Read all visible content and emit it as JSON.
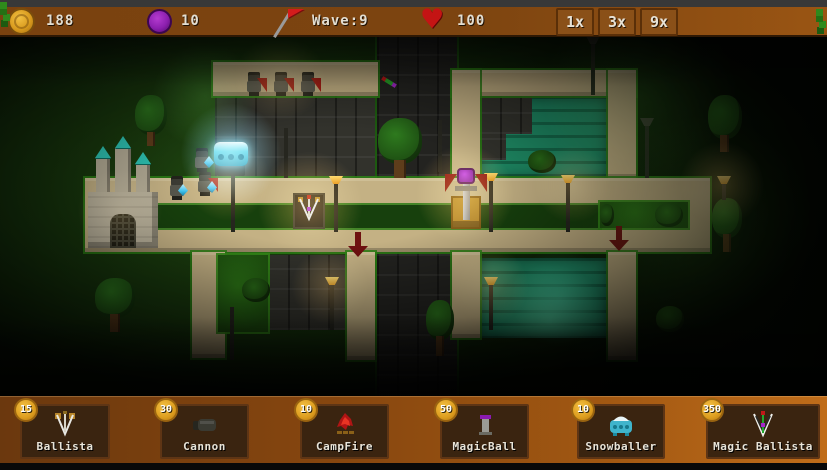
{
  "chrome": {
    "topbar_color": "#383838"
  },
  "hud": {
    "coins": "188",
    "gems": "10",
    "wave": "Wave:9",
    "health": "100",
    "speed_buttons": [
      {
        "label": "1x"
      },
      {
        "label": "3x"
      },
      {
        "label": "9x"
      }
    ],
    "colors": {
      "bar": "#7c4210",
      "coin": "#e2a51f",
      "gem": "#8c1fae",
      "heart": "#c41414",
      "flag": "#d41c1c",
      "text": "#e3ded2"
    },
    "icons": {
      "coin": "gold-coin-circle",
      "gem": "purple-orb-circle",
      "flag": "red-pennant-flag",
      "heart": "red-heart"
    }
  },
  "shop": {
    "items": [
      {
        "name": "Ballista",
        "price": "15"
      },
      {
        "name": "Cannon",
        "price": "30"
      },
      {
        "name": "CampFire",
        "price": "10"
      },
      {
        "name": "MagicBall",
        "price": "50"
      },
      {
        "name": "Snowballer",
        "price": "10"
      },
      {
        "name": "Magic Ballista",
        "price": "350"
      }
    ],
    "colors": {
      "bar": "#8a4912",
      "card": "#3a2410",
      "coin_badge": "#e8a21c"
    }
  },
  "map": {
    "placed_towers": [
      "snowballer",
      "ballista",
      "magic-ball"
    ],
    "enemies_note": "3 red-caped zombies on top path, 3 zombies carrying blue crystals near castle",
    "decor": [
      "castle",
      "trees",
      "bushes",
      "lamp-posts",
      "water-pools",
      "stone-tiles",
      "red-direction-arrows",
      "magic-arrow-projectile"
    ],
    "colors": {
      "grass_dark": "#0c1a06",
      "path": "#c4b184",
      "path_border": "#2e7a1c",
      "water": "#1e8a64",
      "stone": "#32322c",
      "arrow": "#6e1010",
      "glow_warm": "#ffc05e",
      "glow_cyan": "#8ce0ff"
    }
  }
}
